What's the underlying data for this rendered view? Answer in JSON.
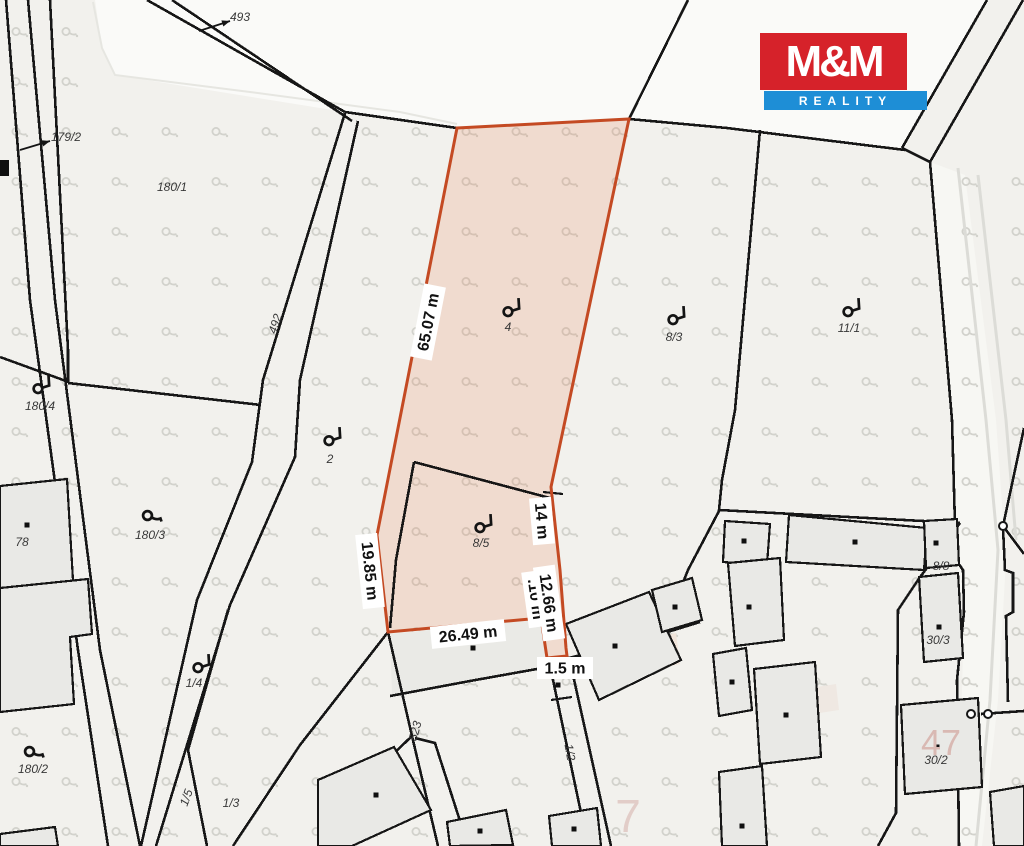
{
  "title": "Cadastral map with highlighted parcel",
  "logo": {
    "line1": "M&M",
    "line2": "REALITY",
    "red": "#d6222a",
    "blue": "#1e8ed6",
    "text_color": "#ffffff"
  },
  "colors": {
    "background": "#f2f1ed",
    "white_area": "#fafaf8",
    "road_strip": "#f7f7f3",
    "line_black": "#161616",
    "building_fill": "#e9e9e6",
    "yard_fill": "#eaeae6",
    "patch_fill": "#f0e4da",
    "gray_road": "#dcdcd7",
    "faint_line": "#e6e6e1",
    "grass": "#d2d2cc",
    "highlight_fill": "rgba(230,110,60,0.17)",
    "highlight_stroke": "#c44a23",
    "measure_bg": "#ffffff",
    "big_label_1": "#e2cdc8",
    "big_label_2": "#d9b9b3"
  },
  "highlight": {
    "outline": [
      [
        457,
        128
      ],
      [
        629,
        119
      ],
      [
        551,
        487
      ],
      [
        560,
        570
      ],
      [
        566,
        648
      ],
      [
        567,
        656
      ],
      [
        547,
        658
      ],
      [
        541,
        618
      ],
      [
        388,
        632
      ],
      [
        377,
        535
      ]
    ]
  },
  "measurements": [
    {
      "id": "len-65",
      "text": "65.07 m",
      "x": 428,
      "y": 322,
      "rot": -79
    },
    {
      "id": "len-19",
      "text": "19.85 m",
      "x": 370,
      "y": 571,
      "rot": 84
    },
    {
      "id": "len-14",
      "text": "14 m",
      "x": 542,
      "y": 521,
      "rot": 85
    },
    {
      "id": "len-hidden",
      "text": ".10 m",
      "x": 536,
      "y": 599,
      "rot": 82
    },
    {
      "id": "len-12",
      "text": "12.66 m",
      "x": 549,
      "y": 603,
      "rot": 82
    },
    {
      "id": "len-26",
      "text": "26.49 m",
      "x": 468,
      "y": 634,
      "rot": -6
    },
    {
      "id": "len-1-5",
      "text": "1.5 m",
      "x": 565,
      "y": 668,
      "rot": 0
    }
  ],
  "parcel_labels": [
    {
      "text": "493",
      "x": 240,
      "y": 17,
      "rot": 0
    },
    {
      "text": "179/2",
      "x": 66,
      "y": 137,
      "rot": 0
    },
    {
      "text": "180/1",
      "x": 172,
      "y": 187,
      "rot": 0
    },
    {
      "text": "492",
      "x": 279,
      "y": 321,
      "rot": -72
    },
    {
      "text": "180/4",
      "x": 40,
      "y": 406,
      "rot": 0
    },
    {
      "text": "2",
      "x": 330,
      "y": 459,
      "rot": 0
    },
    {
      "text": "4",
      "x": 508,
      "y": 327,
      "rot": 0
    },
    {
      "text": "8/3",
      "x": 674,
      "y": 337,
      "rot": 0
    },
    {
      "text": "11/1",
      "x": 849,
      "y": 328,
      "rot": 0
    },
    {
      "text": "180/3",
      "x": 150,
      "y": 535,
      "rot": 0
    },
    {
      "text": "78",
      "x": 22,
      "y": 542,
      "rot": 0
    },
    {
      "text": "8/5",
      "x": 481,
      "y": 543,
      "rot": 0
    },
    {
      "text": "1/4",
      "x": 194,
      "y": 683,
      "rot": 0
    },
    {
      "text": "180/2",
      "x": 33,
      "y": 769,
      "rot": 0
    },
    {
      "text": "1/5",
      "x": 190,
      "y": 795,
      "rot": -70
    },
    {
      "text": "1/3",
      "x": 231,
      "y": 803,
      "rot": 0
    },
    {
      "text": "523",
      "x": 419,
      "y": 728,
      "rot": -75
    },
    {
      "text": "1/2",
      "x": 566,
      "y": 749,
      "rot": 80
    },
    {
      "text": "8/8",
      "x": 941,
      "y": 566,
      "rot": 0
    },
    {
      "text": "30/3",
      "x": 938,
      "y": 640,
      "rot": 0
    },
    {
      "text": "30/2",
      "x": 936,
      "y": 760,
      "rot": 0
    }
  ],
  "big_labels": [
    {
      "text": "7",
      "x": 628,
      "y": 832,
      "size": 46,
      "color": "#e2cdc8"
    },
    {
      "text": "47",
      "x": 941,
      "y": 755,
      "size": 36,
      "color": "#d9b9b3"
    }
  ],
  "symbols": {
    "flag": [
      [
        512,
        307
      ],
      [
        333,
        436
      ],
      [
        677,
        315
      ],
      [
        852,
        307
      ],
      [
        484,
        523
      ],
      [
        42,
        384
      ],
      [
        202,
        663
      ]
    ],
    "curl": [
      [
        153,
        516
      ],
      [
        35,
        752
      ]
    ]
  },
  "arrows": [
    {
      "tail": [
        199,
        31
      ],
      "head": [
        230,
        21
      ]
    },
    {
      "tail": [
        20,
        150
      ],
      "head": [
        50,
        141
      ]
    }
  ],
  "white_areas": [
    {
      "pts": [
        [
          95,
          0
        ],
        [
          987,
          0
        ],
        [
          902,
          148
        ],
        [
          727,
          128
        ],
        [
          629,
          119
        ],
        [
          457,
          128
        ],
        [
          345,
          112
        ],
        [
          115,
          75
        ],
        [
          102,
          48
        ]
      ],
      "fill": "#fafaf8"
    },
    {
      "pts": [
        [
          930,
          162
        ],
        [
          952,
          420
        ],
        [
          957,
          565
        ],
        [
          964,
          612
        ],
        [
          958,
          846
        ],
        [
          982,
          846
        ],
        [
          998,
          700
        ],
        [
          1006,
          560
        ],
        [
          996,
          420
        ],
        [
          965,
          175
        ]
      ],
      "fill": "#f7f7f3"
    }
  ],
  "patches": [
    {
      "pts": [
        [
          390,
          634
        ],
        [
          541,
          619
        ],
        [
          548,
          667
        ],
        [
          470,
          682
        ],
        [
          392,
          695
        ]
      ],
      "fill": "#eaeae6"
    },
    {
      "pts": [
        [
          648,
          640
        ],
        [
          676,
          633
        ],
        [
          680,
          664
        ],
        [
          652,
          670
        ]
      ],
      "fill": "#f0e4da"
    },
    {
      "pts": [
        [
          810,
          688
        ],
        [
          836,
          684
        ],
        [
          839,
          710
        ],
        [
          813,
          714
        ]
      ],
      "fill": "#efe8e2"
    }
  ],
  "faint_lines": [
    {
      "pts": [
        [
          93,
          2
        ],
        [
          102,
          48
        ],
        [
          115,
          75
        ],
        [
          250,
          92
        ],
        [
          400,
          112
        ],
        [
          457,
          124
        ]
      ]
    }
  ],
  "gray_lines": [
    {
      "pts": [
        [
          958,
          168
        ],
        [
          986,
          420
        ],
        [
          998,
          550
        ],
        [
          990,
          700
        ],
        [
          976,
          846
        ]
      ]
    },
    {
      "pts": [
        [
          978,
          175
        ],
        [
          1006,
          420
        ],
        [
          1016,
          540
        ]
      ]
    }
  ],
  "lines": [
    {
      "pts": [
        [
          6,
          0
        ],
        [
          30,
          300
        ],
        [
          78,
          650
        ],
        [
          108,
          846
        ]
      ]
    },
    {
      "pts": [
        [
          28,
          0
        ],
        [
          55,
          300
        ],
        [
          100,
          650
        ],
        [
          140,
          846
        ]
      ]
    },
    {
      "pts": [
        [
          50,
          0
        ],
        [
          68,
          350
        ],
        [
          68,
          383
        ]
      ]
    },
    {
      "pts": [
        [
          0,
          357
        ],
        [
          66,
          381
        ]
      ]
    },
    {
      "pts": [
        [
          68,
          383
        ],
        [
          261,
          405
        ]
      ]
    },
    {
      "pts": [
        [
          345,
          113
        ],
        [
          263,
          380
        ],
        [
          252,
          462
        ],
        [
          197,
          600
        ],
        [
          141,
          846
        ]
      ]
    },
    {
      "pts": [
        [
          358,
          121
        ],
        [
          300,
          380
        ],
        [
          295,
          457
        ],
        [
          230,
          605
        ],
        [
          156,
          846
        ]
      ]
    },
    {
      "pts": [
        [
          228,
          610
        ],
        [
          188,
          750
        ],
        [
          207,
          846
        ]
      ]
    },
    {
      "pts": [
        [
          388,
          632
        ],
        [
          300,
          745
        ],
        [
          233,
          846
        ]
      ]
    },
    {
      "pts": [
        [
          412,
          736
        ],
        [
          345,
          800
        ],
        [
          330,
          846
        ]
      ]
    },
    {
      "pts": [
        [
          388,
          632
        ],
        [
          412,
          736
        ],
        [
          438,
          846
        ]
      ]
    },
    {
      "pts": [
        [
          415,
          738
        ],
        [
          435,
          743
        ],
        [
          468,
          846
        ]
      ]
    },
    {
      "pts": [
        [
          147,
          0
        ],
        [
          345,
          112
        ]
      ]
    },
    {
      "pts": [
        [
          172,
          0
        ],
        [
          352,
          121
        ]
      ]
    },
    {
      "pts": [
        [
          345,
          112
        ],
        [
          457,
          128
        ]
      ]
    },
    {
      "pts": [
        [
          629,
          119
        ],
        [
          727,
          128
        ],
        [
          905,
          150
        ]
      ]
    },
    {
      "pts": [
        [
          688,
          0
        ],
        [
          629,
          119
        ]
      ]
    },
    {
      "pts": [
        [
          987,
          0
        ],
        [
          902,
          148
        ]
      ]
    },
    {
      "pts": [
        [
          1023,
          0
        ],
        [
          930,
          162
        ]
      ]
    },
    {
      "pts": [
        [
          902,
          148
        ],
        [
          930,
          162
        ]
      ]
    },
    {
      "pts": [
        [
          930,
          162
        ],
        [
          952,
          420
        ],
        [
          956,
          560
        ],
        [
          963,
          570
        ],
        [
          964,
          612
        ],
        [
          957,
          680
        ],
        [
          959,
          846
        ]
      ]
    },
    {
      "pts": [
        [
          722,
          480
        ],
        [
          719,
          510
        ],
        [
          960,
          523
        ]
      ]
    },
    {
      "pts": [
        [
          760,
          130
        ],
        [
          735,
          410
        ],
        [
          722,
          480
        ]
      ]
    },
    {
      "pts": [
        [
          719,
          511
        ],
        [
          688,
          570
        ],
        [
          666,
          625
        ]
      ]
    },
    {
      "pts": [
        [
          960,
          523
        ],
        [
          918,
          580
        ],
        [
          898,
          610
        ],
        [
          896,
          813
        ],
        [
          878,
          846
        ]
      ]
    },
    {
      "pts": [
        [
          414,
          462
        ],
        [
          550,
          498
        ]
      ]
    },
    {
      "pts": [
        [
          414,
          462
        ],
        [
          396,
          560
        ],
        [
          390,
          628
        ]
      ]
    },
    {
      "pts": [
        [
          543,
          492
        ],
        [
          563,
          494
        ]
      ],
      "w": 2.2
    },
    {
      "pts": [
        [
          390,
          696
        ],
        [
          470,
          681
        ],
        [
          548,
          667
        ]
      ]
    },
    {
      "pts": [
        [
          569,
          658
        ],
        [
          648,
          638
        ],
        [
          700,
          622
        ]
      ]
    },
    {
      "pts": [
        [
          549,
          661
        ],
        [
          588,
          846
        ]
      ]
    },
    {
      "pts": [
        [
          569,
          657
        ],
        [
          611,
          846
        ]
      ]
    },
    {
      "pts": [
        [
          551,
          700
        ],
        [
          572,
          697
        ]
      ],
      "w": 2.2
    },
    {
      "pts": [
        [
          1024,
          428
        ],
        [
          1003,
          526
        ]
      ]
    },
    {
      "pts": [
        [
          1003,
          526
        ],
        [
          1024,
          554
        ]
      ]
    },
    {
      "pts": [
        [
          1003,
          528
        ],
        [
          1005,
          570
        ],
        [
          1013,
          573
        ],
        [
          1013,
          612
        ],
        [
          1006,
          616
        ],
        [
          1008,
          702
        ]
      ]
    },
    {
      "pts": [
        [
          981,
          714
        ],
        [
          1024,
          711
        ]
      ]
    }
  ],
  "buildings": [
    {
      "pts": [
        [
          0,
          486
        ],
        [
          67,
          479
        ],
        [
          75,
          614
        ],
        [
          0,
          622
        ]
      ],
      "dot": [
        27,
        525
      ]
    },
    {
      "pts": [
        [
          0,
          588
        ],
        [
          88,
          579
        ],
        [
          92,
          634
        ],
        [
          70,
          637
        ],
        [
          74,
          704
        ],
        [
          0,
          712
        ]
      ]
    },
    {
      "pts": [
        [
          0,
          834
        ],
        [
          55,
          827
        ],
        [
          58,
          846
        ],
        [
          0,
          846
        ]
      ]
    },
    {
      "pts": [
        [
          318,
          780
        ],
        [
          394,
          747
        ],
        [
          431,
          810
        ],
        [
          352,
          846
        ],
        [
          318,
          846
        ]
      ],
      "dot": [
        376,
        795
      ]
    },
    {
      "pts": [
        [
          447,
          822
        ],
        [
          506,
          810
        ],
        [
          513,
          845
        ],
        [
          450,
          846
        ]
      ],
      "dot": [
        480,
        831
      ]
    },
    {
      "pts": [
        [
          549,
          816
        ],
        [
          597,
          808
        ],
        [
          601,
          846
        ],
        [
          552,
          846
        ]
      ],
      "dot": [
        574,
        829
      ]
    },
    {
      "pts": [
        [
          566,
          624
        ],
        [
          649,
          592
        ],
        [
          681,
          660
        ],
        [
          599,
          700
        ]
      ],
      "dot": [
        615,
        646
      ]
    },
    {
      "pts": [
        [
          652,
          590
        ],
        [
          692,
          578
        ],
        [
          702,
          620
        ],
        [
          662,
          632
        ]
      ],
      "dot": [
        675,
        607
      ]
    },
    {
      "pts": [
        [
          725,
          521
        ],
        [
          770,
          524
        ],
        [
          767,
          565
        ],
        [
          723,
          562
        ]
      ],
      "dot": [
        744,
        541
      ]
    },
    {
      "pts": [
        [
          728,
          563
        ],
        [
          780,
          558
        ],
        [
          784,
          640
        ],
        [
          735,
          646
        ]
      ],
      "dot": [
        749,
        607
      ]
    },
    {
      "pts": [
        [
          713,
          654
        ],
        [
          746,
          648
        ],
        [
          752,
          710
        ],
        [
          719,
          716
        ]
      ],
      "dot": [
        732,
        682
      ]
    },
    {
      "pts": [
        [
          754,
          669
        ],
        [
          815,
          662
        ],
        [
          821,
          757
        ],
        [
          760,
          764
        ]
      ],
      "dot": [
        786,
        715
      ]
    },
    {
      "pts": [
        [
          719,
          772
        ],
        [
          762,
          766
        ],
        [
          767,
          846
        ],
        [
          722,
          846
        ]
      ],
      "dot": [
        742,
        826
      ]
    },
    {
      "pts": [
        [
          789,
          515
        ],
        [
          927,
          528
        ],
        [
          924,
          570
        ],
        [
          786,
          562
        ]
      ],
      "dot": [
        855,
        542
      ]
    },
    {
      "pts": [
        [
          924,
          521
        ],
        [
          957,
          519
        ],
        [
          959,
          565
        ],
        [
          926,
          568
        ]
      ],
      "dot": [
        936,
        543
      ]
    },
    {
      "pts": [
        [
          919,
          577
        ],
        [
          958,
          573
        ],
        [
          963,
          658
        ],
        [
          924,
          662
        ]
      ],
      "dot": [
        939,
        627
      ]
    },
    {
      "pts": [
        [
          901,
          705
        ],
        [
          978,
          698
        ],
        [
          982,
          787
        ],
        [
          905,
          794
        ]
      ],
      "dot": [
        937,
        747
      ]
    },
    {
      "pts": [
        [
          990,
          792
        ],
        [
          1024,
          786
        ],
        [
          1024,
          846
        ],
        [
          994,
          846
        ]
      ]
    }
  ],
  "point_dots": [
    [
      473,
      648
    ],
    [
      558,
      685
    ]
  ],
  "vertex_circles": [
    [
      1003,
      526
    ],
    [
      971,
      714
    ],
    [
      988,
      714
    ]
  ],
  "edge_marks": [
    {
      "x": 0,
      "y": 160,
      "w": 9,
      "h": 16
    }
  ],
  "grass_grid": {
    "x0": 12,
    "y0": 27,
    "dx": 50,
    "dy": 50,
    "cols": 21,
    "rows": 17,
    "exclusions": [
      [
        95,
        0,
        600,
        112
      ],
      [
        700,
        0,
        324,
        150
      ],
      [
        745,
        20,
        200,
        95
      ]
    ]
  }
}
